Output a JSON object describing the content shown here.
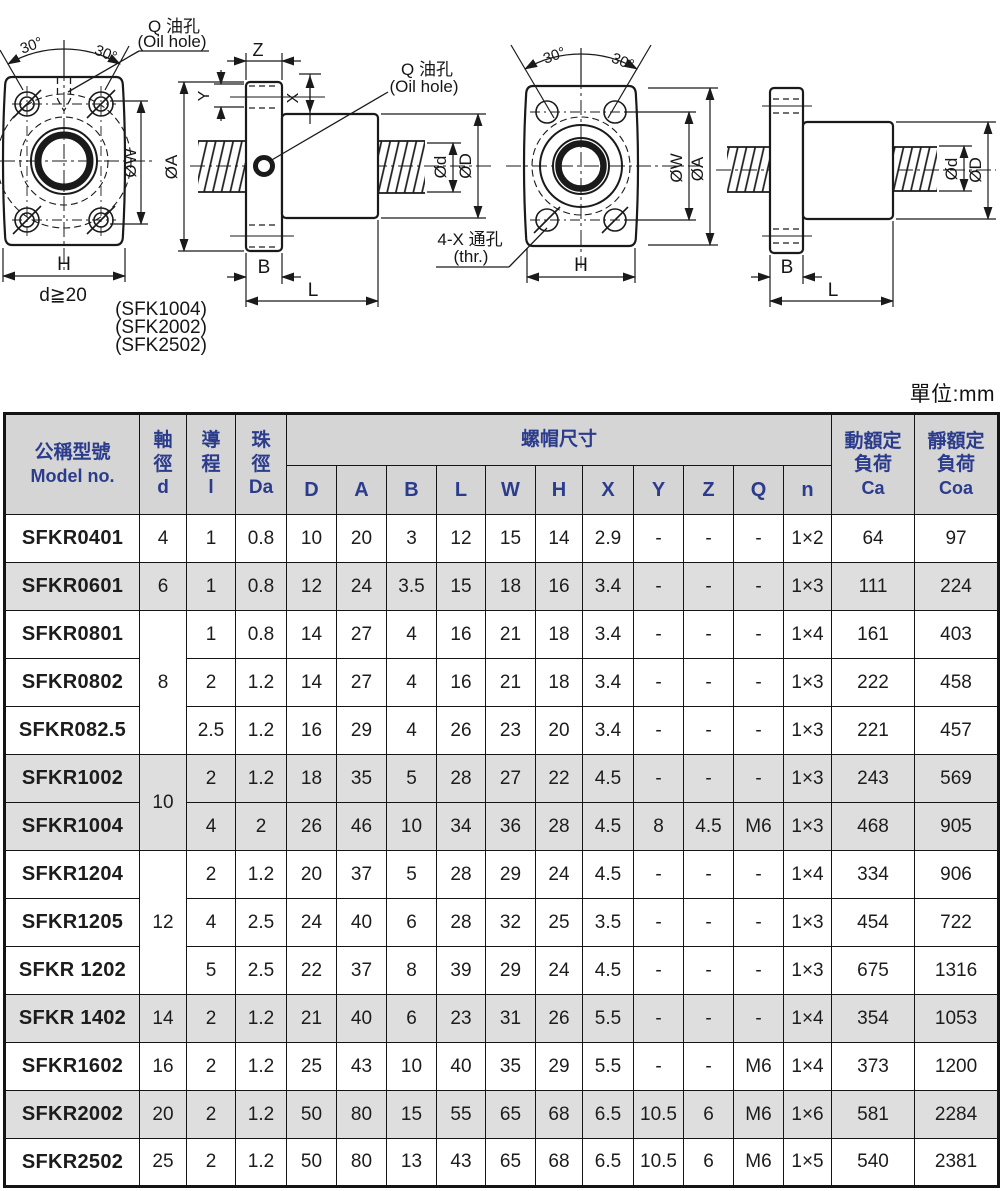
{
  "units_label": "單位:mm",
  "drawings": {
    "left": {
      "oil_hole_top": {
        "l1": "Q 油孔",
        "l2": "(Oil hole)"
      },
      "oil_hole_side": {
        "l1": "Q 油孔",
        "l2": "(Oil hole)"
      },
      "angle_left": "30°",
      "angle_right": "30°",
      "dims": {
        "w": "ØW",
        "a": "ØA",
        "h": "H",
        "z": "Z",
        "y": "Y",
        "x": "X",
        "d": "Ød",
        "D": "ØD",
        "b": "B",
        "l": "L"
      },
      "shaft_note": "d≧20",
      "variants": [
        "(SFK1004)",
        "(SFK2002)",
        "(SFK2502)"
      ]
    },
    "right": {
      "angle_left": "30°",
      "angle_right": "30°",
      "thru_hole": {
        "l1": "4-X 通孔",
        "l2": "(thr.)"
      },
      "dims": {
        "w": "ØW",
        "a": "ØA",
        "h": "H",
        "d": "Ød",
        "D": "ØD",
        "b": "B",
        "l": "L"
      }
    }
  },
  "table": {
    "header": {
      "model_l1": "公稱型號",
      "model_l2": "Model no.",
      "shaft": [
        "軸",
        "徑",
        "d"
      ],
      "lead": [
        "導",
        "程",
        "l"
      ],
      "ball": [
        "珠",
        "徑",
        "Da"
      ],
      "nut_group": "螺帽尺寸",
      "nut_cols": [
        "D",
        "A",
        "B",
        "L",
        "W",
        "H",
        "X",
        "Y",
        "Z",
        "Q",
        "n"
      ],
      "dyn": [
        "動額定",
        "負荷",
        "Ca"
      ],
      "stat": [
        "靜額定",
        "負荷",
        "Coa"
      ]
    },
    "rows": [
      {
        "model": "SFKR0401",
        "d": "4",
        "d_span": 1,
        "lead": "1",
        "da": "0.8",
        "dims": [
          "10",
          "20",
          "3",
          "12",
          "15",
          "14",
          "2.9",
          "-",
          "-",
          "-",
          "1×2"
        ],
        "ca": "64",
        "coa": "97",
        "shaded": false
      },
      {
        "model": "SFKR0601",
        "d": "6",
        "d_span": 1,
        "lead": "1",
        "da": "0.8",
        "dims": [
          "12",
          "24",
          "3.5",
          "15",
          "18",
          "16",
          "3.4",
          "-",
          "-",
          "-",
          "1×3"
        ],
        "ca": "111",
        "coa": "224",
        "shaded": true
      },
      {
        "model": "SFKR0801",
        "d": "8",
        "d_span": 3,
        "lead": "1",
        "da": "0.8",
        "dims": [
          "14",
          "27",
          "4",
          "16",
          "21",
          "18",
          "3.4",
          "-",
          "-",
          "-",
          "1×4"
        ],
        "ca": "161",
        "coa": "403",
        "shaded": false
      },
      {
        "model": "SFKR0802",
        "d": null,
        "d_span": 0,
        "lead": "2",
        "da": "1.2",
        "dims": [
          "14",
          "27",
          "4",
          "16",
          "21",
          "18",
          "3.4",
          "-",
          "-",
          "-",
          "1×3"
        ],
        "ca": "222",
        "coa": "458",
        "shaded": false
      },
      {
        "model": "SFKR082.5",
        "d": null,
        "d_span": 0,
        "lead": "2.5",
        "da": "1.2",
        "dims": [
          "16",
          "29",
          "4",
          "26",
          "23",
          "20",
          "3.4",
          "-",
          "-",
          "-",
          "1×3"
        ],
        "ca": "221",
        "coa": "457",
        "shaded": false
      },
      {
        "model": "SFKR1002",
        "d": "10",
        "d_span": 2,
        "lead": "2",
        "da": "1.2",
        "dims": [
          "18",
          "35",
          "5",
          "28",
          "27",
          "22",
          "4.5",
          "-",
          "-",
          "-",
          "1×3"
        ],
        "ca": "243",
        "coa": "569",
        "shaded": true
      },
      {
        "model": "SFKR1004",
        "d": null,
        "d_span": 0,
        "lead": "4",
        "da": "2",
        "dims": [
          "26",
          "46",
          "10",
          "34",
          "36",
          "28",
          "4.5",
          "8",
          "4.5",
          "M6",
          "1×3"
        ],
        "ca": "468",
        "coa": "905",
        "shaded": true
      },
      {
        "model": "SFKR1204",
        "d": "12",
        "d_span": 3,
        "lead": "2",
        "da": "1.2",
        "dims": [
          "20",
          "37",
          "5",
          "28",
          "29",
          "24",
          "4.5",
          "-",
          "-",
          "-",
          "1×4"
        ],
        "ca": "334",
        "coa": "906",
        "shaded": false
      },
      {
        "model": "SFKR1205",
        "d": null,
        "d_span": 0,
        "lead": "4",
        "da": "2.5",
        "dims": [
          "24",
          "40",
          "6",
          "28",
          "32",
          "25",
          "3.5",
          "-",
          "-",
          "-",
          "1×3"
        ],
        "ca": "454",
        "coa": "722",
        "shaded": false
      },
      {
        "model": "SFKR 1202",
        "d": null,
        "d_span": 0,
        "lead": "5",
        "da": "2.5",
        "dims": [
          "22",
          "37",
          "8",
          "39",
          "29",
          "24",
          "4.5",
          "-",
          "-",
          "-",
          "1×3"
        ],
        "ca": "675",
        "coa": "1316",
        "shaded": false
      },
      {
        "model": "SFKR 1402",
        "d": "14",
        "d_span": 1,
        "lead": "2",
        "da": "1.2",
        "dims": [
          "21",
          "40",
          "6",
          "23",
          "31",
          "26",
          "5.5",
          "-",
          "-",
          "-",
          "1×4"
        ],
        "ca": "354",
        "coa": "1053",
        "shaded": true
      },
      {
        "model": "SFKR1602",
        "d": "16",
        "d_span": 1,
        "lead": "2",
        "da": "1.2",
        "dims": [
          "25",
          "43",
          "10",
          "40",
          "35",
          "29",
          "5.5",
          "-",
          "-",
          "M6",
          "1×4"
        ],
        "ca": "373",
        "coa": "1200",
        "shaded": false
      },
      {
        "model": "SFKR2002",
        "d": "20",
        "d_span": 1,
        "lead": "2",
        "da": "1.2",
        "dims": [
          "50",
          "80",
          "15",
          "55",
          "65",
          "68",
          "6.5",
          "10.5",
          "6",
          "M6",
          "1×6"
        ],
        "ca": "581",
        "coa": "2284",
        "shaded": true
      },
      {
        "model": "SFKR2502",
        "d": "25",
        "d_span": 1,
        "lead": "2",
        "da": "1.2",
        "dims": [
          "50",
          "80",
          "13",
          "43",
          "65",
          "68",
          "6.5",
          "10.5",
          "6",
          "M6",
          "1×5"
        ],
        "ca": "540",
        "coa": "2381",
        "shaded": false
      }
    ]
  }
}
